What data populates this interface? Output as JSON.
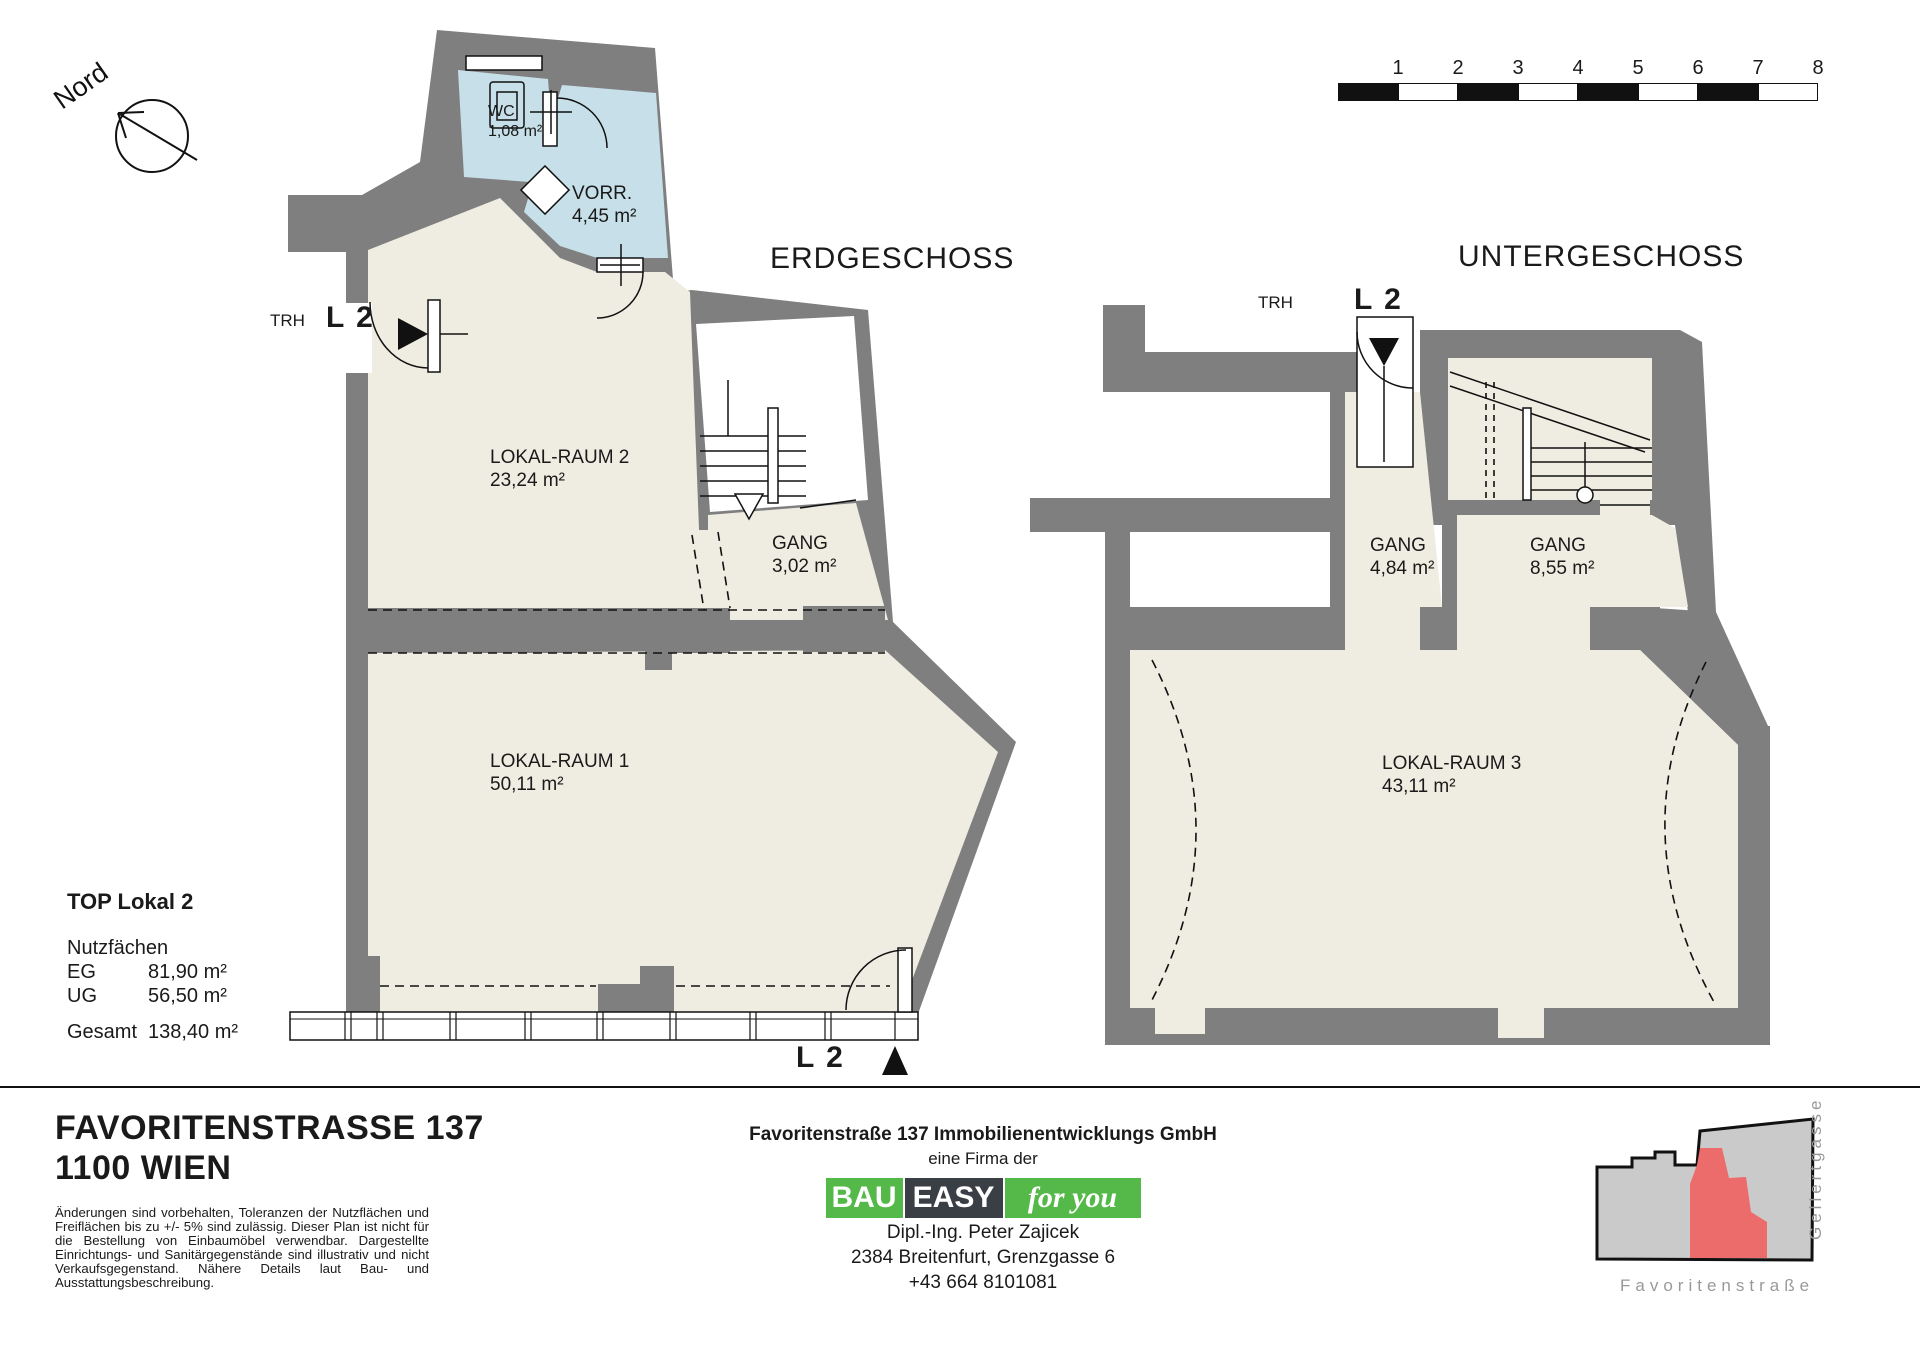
{
  "compass": {
    "label": "Nord"
  },
  "scale_bar": {
    "numbers": [
      "1",
      "2",
      "3",
      "4",
      "5",
      "6",
      "7",
      "8"
    ]
  },
  "plans": {
    "eg": {
      "title": "ERDGESCHOSS",
      "rooms": [
        {
          "name": "WC",
          "area": "1,08 m²"
        },
        {
          "name": "VORR.",
          "area": "4,45 m²"
        },
        {
          "name": "LOKAL-RAUM 2",
          "area": "23,24 m²"
        },
        {
          "name": "GANG",
          "area": "3,02 m²"
        },
        {
          "name": "LOKAL-RAUM 1",
          "area": "50,11 m²"
        }
      ],
      "entrance_side": {
        "trh": "TRH",
        "unit": "L 2"
      },
      "entrance_front": {
        "unit": "L 2"
      }
    },
    "ug": {
      "title": "UNTERGESCHOSS",
      "rooms": [
        {
          "name": "GANG",
          "area": "4,84 m²"
        },
        {
          "name": "GANG",
          "area": "8,55 m²"
        },
        {
          "name": "LOKAL-RAUM 3",
          "area": "43,11 m²"
        }
      ],
      "entrance": {
        "trh": "TRH",
        "unit": "L 2"
      }
    }
  },
  "summary": {
    "title": "TOP Lokal 2",
    "section": "Nutzfächen",
    "rows": [
      {
        "label": "EG",
        "value": "81,90 m²"
      },
      {
        "label": "UG",
        "value": "56,50 m²"
      }
    ],
    "total_label": "Gesamt",
    "total_value": "138,40 m²"
  },
  "title_block": {
    "address_line1": "FAVORITENSTRASSE  137",
    "address_line2": "1100 WIEN",
    "disclaimer": "Änderungen sind vorbehalten, Toleranzen der Nutzflächen und Freiflächen bis zu +/- 5% sind zulässig. Dieser Plan ist nicht für die Bestellung von Einbaumöbel verwendbar. Dargestellte Einrichtungs- und Sanitärgegenstände sind illustrativ und nicht Verkaufsgegenstand.  Nähere Details laut Bau- und Ausstattungsbeschreibung.",
    "company": "Favoritenstraße 137 Immobilienentwicklungs GmbH",
    "firma": "eine Firma der",
    "logo": {
      "part1": "BAU",
      "part2": "EASY",
      "part3": "for you"
    },
    "contact_name": "Dipl.-Ing. Peter Zajicek",
    "contact_address": "2384 Breitenfurt, Grenzgasse 6",
    "contact_phone": "+43 664 8101081"
  },
  "site_map": {
    "street_side": "Gellertgasse",
    "street_bottom": "Favoritenstraße"
  },
  "colors": {
    "wall_gray": "#7f7f7f",
    "room_cream": "#efece1",
    "wet_room_blue": "#c6dfe8",
    "map_gray": "#cacaca",
    "map_red": "#ec6b6b",
    "logo_green": "#54b948",
    "logo_dark": "#3a3f46"
  }
}
